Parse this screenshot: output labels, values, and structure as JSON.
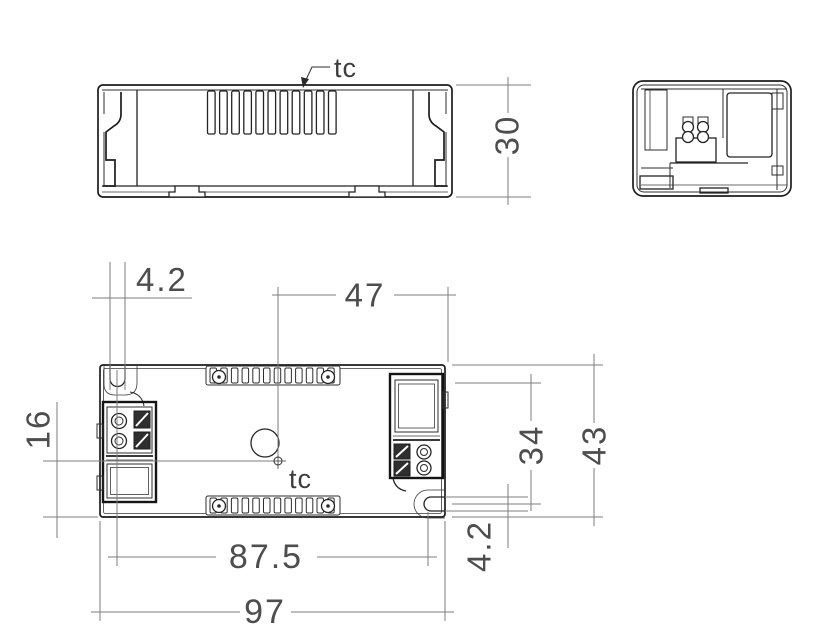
{
  "page": {
    "background": "#ffffff",
    "part_line_color": "#1d1d1d",
    "dimension_line_color": "#7e7e7e",
    "dimension_text_color": "#4d4d4d",
    "description": "Technical dimension drawing of LED driver enclosure, three views"
  },
  "side_view": {
    "tc_label": "tc",
    "height_dim": "30"
  },
  "end_view": {},
  "top_view": {
    "tc_label": "tc",
    "slot_width_top_dim": "4.2",
    "tc_to_right_slot_dim": "47",
    "centerline_to_bottom_dim": "16",
    "slot_offset_dim": "34",
    "body_width_dim": "43",
    "mounting_distance_dim": "87.5",
    "slot_width_right_dim": "4.2",
    "body_length_dim": "97"
  }
}
